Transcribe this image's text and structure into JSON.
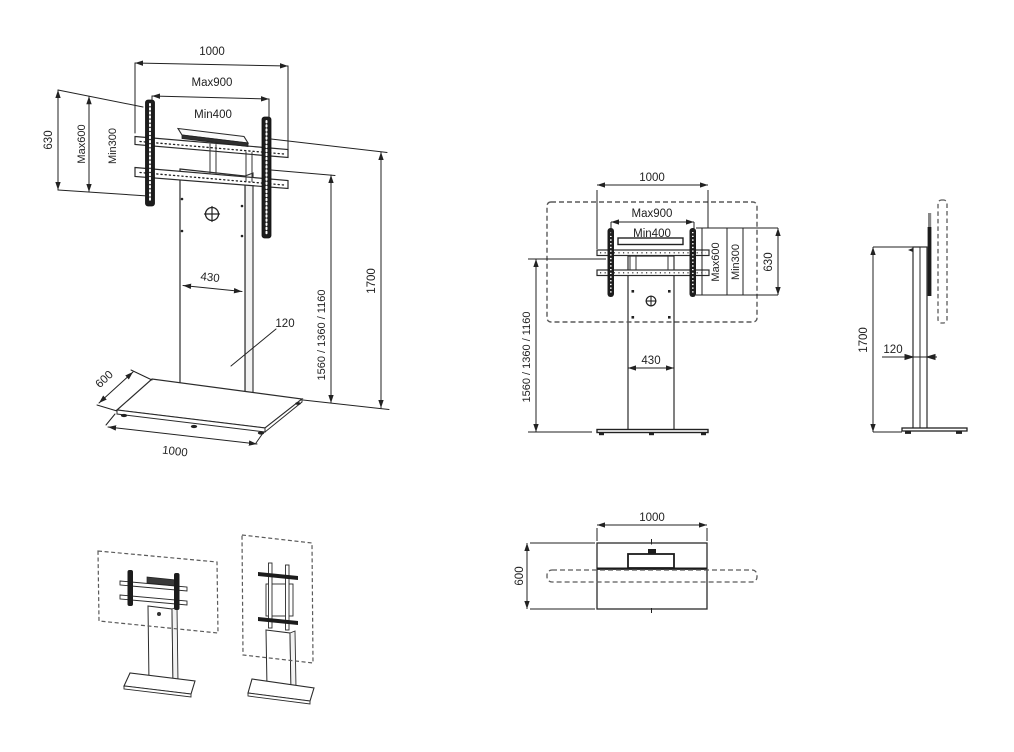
{
  "drawing": {
    "kind": "TV floor-stand dimensioned technical drawing",
    "views": {
      "perspective": {
        "dim_overall_width": "1000",
        "dim_vesa_width_max": "Max900",
        "dim_vesa_width_min": "Min400",
        "dim_bracket_height": "630",
        "dim_vesa_height_max": "Max600",
        "dim_vesa_height_min": "Min300",
        "dim_column_width": "430",
        "dim_column_depth": "120",
        "dim_mount_heights": "1560 / 1360 / 1160",
        "dim_total_height": "1700",
        "dim_base_depth": "600",
        "dim_base_width": "1000"
      },
      "front": {
        "dim_overall_width": "1000",
        "dim_vesa_width_max": "Max900",
        "dim_vesa_width_min": "Min400",
        "dim_vesa_height_max": "Max600",
        "dim_vesa_height_min": "Min300",
        "dim_bracket_height": "630",
        "dim_mount_heights": "1560 / 1360 / 1160",
        "dim_column_width": "430"
      },
      "side": {
        "dim_total_height": "1700",
        "dim_column_depth": "120"
      },
      "top": {
        "dim_base_width": "1000",
        "dim_base_depth": "600"
      }
    },
    "colors": {
      "line": "#2b2b2b",
      "dashed_outline": "#5a5a5a",
      "dark_fill": "#1c1c1c",
      "background": "#ffffff"
    }
  }
}
